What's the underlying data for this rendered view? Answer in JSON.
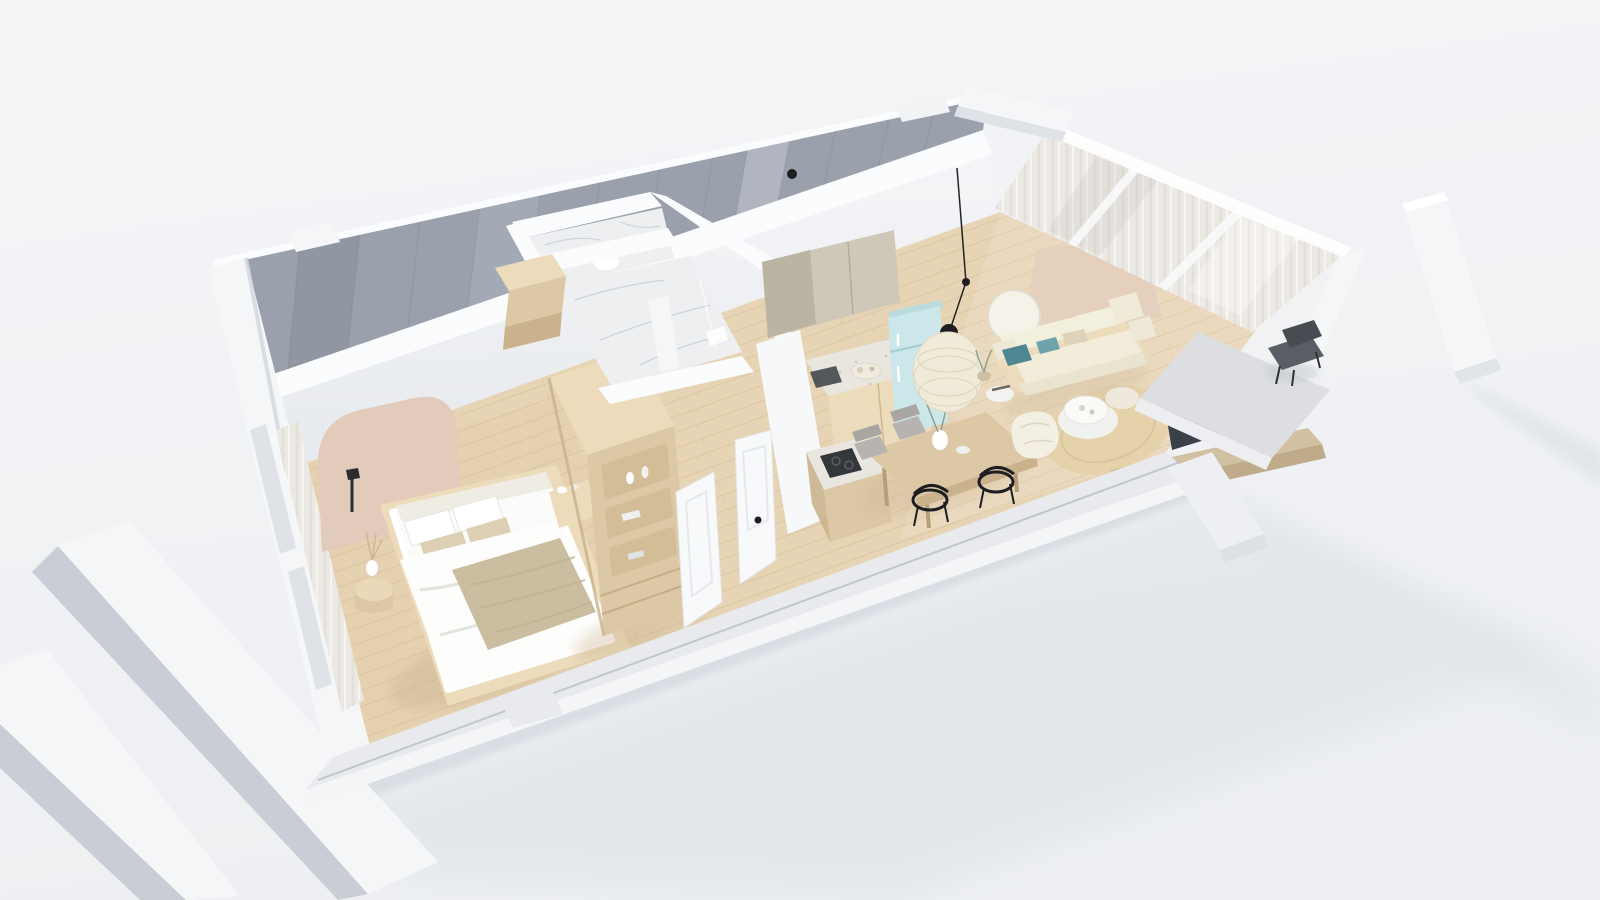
{
  "scene": {
    "title": "3D apartment dollhouse cutaway render",
    "style": "scandinavian minimal",
    "view": "aerial perspective, walls cut, no text labels"
  },
  "colors": {
    "bg_top": "#f4f5f7",
    "bg_bottom": "#edeff2",
    "shadow": "#dfe3e8",
    "contact_shadow": "#c9ced6",
    "wall_white": "#f5f6f8",
    "wall_cut": "#fbfcfd",
    "wall_face_gray": "#c9cdd5",
    "panel_gray": "#9aa1ad",
    "panel_gray_dark": "#8f97a3",
    "inner_wall": "#f6f7f9",
    "inner_wall_deep": "#e6e9ed",
    "floor_wood": "#e7d4b5",
    "plank": "#cdb794",
    "marble": "#edeff1",
    "marble_vein": "#c6cbd3",
    "arch_beige": "#e2cbba",
    "accent_panel": "#e5cfbd",
    "wood_light": "#ecdcbc",
    "wood_mid": "#dcc8a4",
    "wood_dark": "#c9b28c",
    "mattress": "#fbfbfa",
    "throw": "#cbbda0",
    "pillow_beige": "#dccfb4",
    "sofa_cream": "#f1edda",
    "teal": "#4e8791",
    "rug": "#e5d2ab",
    "mint": "#cbe7e9",
    "mint_dark": "#b9dbde",
    "terrazzo": "#e9e6df",
    "cabinet_taupe": "#cfc8b8",
    "cabinet_taupe2": "#bcb4a3",
    "tv": "#3a4048",
    "black": "#1e1e22",
    "chair_gray": "#b7b3b0",
    "curtain": "#ece9e4",
    "curtain_dark": "#d6d2cb",
    "balcony": "#dcdee1",
    "lamp": "#f0ead8",
    "glass": "#dfe3e8",
    "green": "#8fa08a"
  },
  "rooms": [
    {
      "name": "bedroom",
      "furniture": [
        "platform-double-bed",
        "arched-headboard-panel",
        "black-wall-sconce",
        "round-pedestal-side-table",
        "vase-with-dried-branches",
        "nightstand",
        "wardrobe-with-open-shelves",
        "sheer-window-curtains"
      ]
    },
    {
      "name": "bathroom",
      "furniture": [
        "marble-shower-room",
        "marble-wc-room",
        "toilet",
        "shower-glass-partition"
      ]
    },
    {
      "name": "hallway",
      "furniture": [
        "entry-door-closed",
        "bedroom-door-open",
        "entry-cabinet"
      ]
    },
    {
      "name": "kitchen",
      "furniture": [
        "taupe-upper-cabinets",
        "terrazzo-countertop",
        "wood-base-cabinets",
        "mint-retro-fridge",
        "island-with-dark-cooktop"
      ]
    },
    {
      "name": "dining-area",
      "furniture": [
        "wood-dining-table",
        "two-black-wire-chairs",
        "two-gray-upholstered-chairs",
        "rattan-pendant-lamp",
        "white-table-vase"
      ]
    },
    {
      "name": "living-room",
      "furniture": [
        "cream-wood-base-sofa",
        "teal-accent-cushions",
        "beige-accent-wall-panel",
        "round-wall-mirror",
        "side-table-with-books",
        "two-round-coffee-tables",
        "cream-bean-bag-pouf",
        "round-jute-rug",
        "flat-tv",
        "long-wood-tv-console",
        "sheer-floor-to-ceiling-curtains"
      ]
    },
    {
      "name": "balcony",
      "furniture": [
        "dark-lounge-chair",
        "concrete-floor",
        "white-structural-columns"
      ]
    }
  ]
}
